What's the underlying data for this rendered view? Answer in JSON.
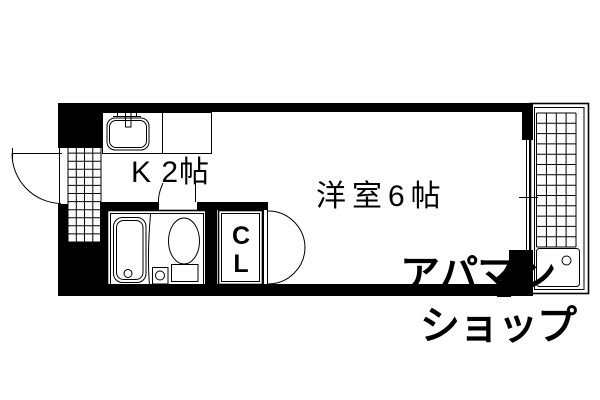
{
  "floorplan": {
    "background": "#ffffff",
    "wall_color": "#000000",
    "line_color": "#000000",
    "rooms": [
      {
        "id": "kitchen",
        "label": "K 2帖"
      },
      {
        "id": "western-room",
        "label": "洋室6帖"
      },
      {
        "id": "closet",
        "label_lines": [
          "C",
          "L"
        ]
      }
    ],
    "fixtures": [
      "entrance-door",
      "entrance-tile",
      "kitchen-counter",
      "kitchen-sink",
      "faucet",
      "bathtub",
      "shower-curtain",
      "washbasin",
      "toilet",
      "closet-double-doors",
      "window",
      "balcony",
      "balcony-grid",
      "washing-machine-pan"
    ],
    "watermark": {
      "line1": "アパマン",
      "line2": "ショップ",
      "color": "#e0e0e0"
    }
  }
}
